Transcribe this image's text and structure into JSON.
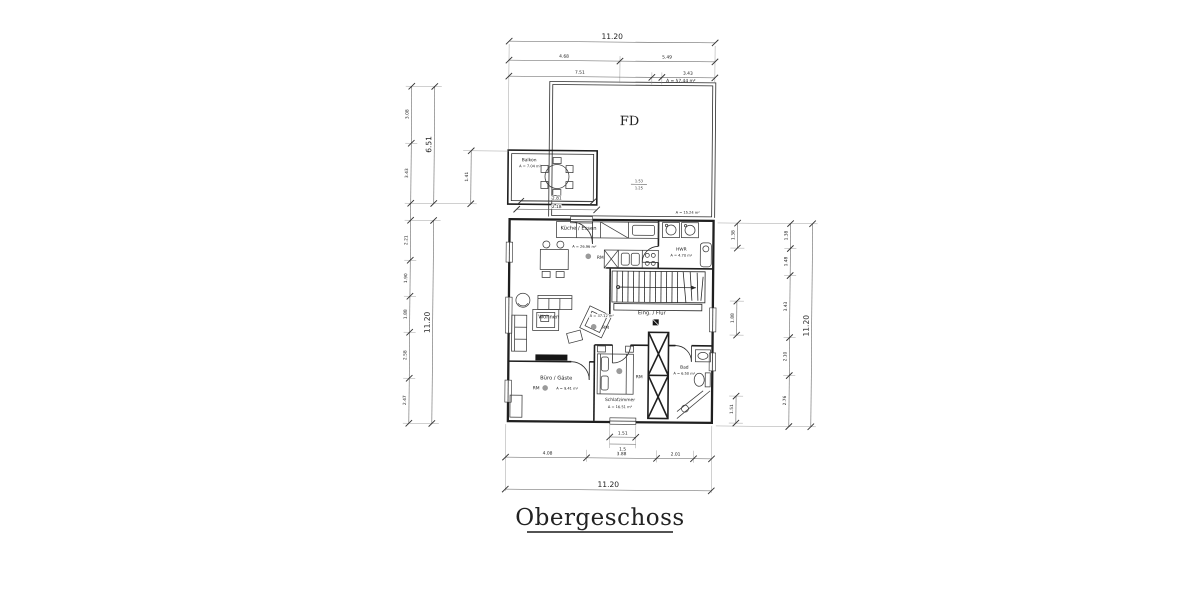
{
  "title": "Obergeschoss",
  "plan": {
    "roof": {
      "label": "FD",
      "area": "A = 57.44 m²",
      "area_lower": "A = 15.24 m²",
      "dims": [
        "1.53",
        "1.25"
      ]
    },
    "balcony": {
      "label": "Balkon",
      "area": "A = 7.04 m²",
      "dims": [
        "2.81",
        "2.18"
      ]
    },
    "rooms": {
      "kitchen": {
        "name": "Küche / Essen",
        "area": "A = 26.96 m²",
        "rm": "RM"
      },
      "hwr": {
        "name": "HWR",
        "area": "A = 4.70 m²"
      },
      "living": {
        "name": "Wohnen",
        "area": "A = 37.12 m²",
        "rm": "RM"
      },
      "hall": {
        "name": "Eing. / Flur"
      },
      "office": {
        "name": "Büro / Gäste",
        "area": "A = 9.41 m²",
        "rm": "RM"
      },
      "bedroom": {
        "name": "Schlafzimmer",
        "area": "A = 16.51 m²",
        "rm": "RM"
      },
      "bath": {
        "name": "Bad",
        "area": "A = 6.50 m²"
      }
    }
  },
  "dims": {
    "top": {
      "total": "11.20",
      "segs": [
        "4.68",
        "5.49",
        "7.51",
        "3.43"
      ]
    },
    "left": {
      "total": "11.20",
      "upper": "6.51",
      "inner": "1.41",
      "chain": [
        "3.08",
        "3.43",
        "2.21",
        "1.90",
        "1.88",
        "2.58",
        "2.47"
      ]
    },
    "right": {
      "total": "11.20",
      "chain": [
        "1.38",
        "1.48",
        "3.43",
        "2.10",
        "2.76"
      ],
      "small": [
        "1.38",
        "1.88",
        "1.51"
      ]
    },
    "bottom": {
      "total": "11.20",
      "small": [
        "1.51",
        "1.5"
      ],
      "chain": [
        "4.08",
        "3.88",
        "2.01"
      ]
    }
  },
  "colors": {
    "ink": "#1f1f1f",
    "dim_line": "#5a5a5a",
    "hatch": "#8f8f8f",
    "paper": "#ffffff"
  }
}
